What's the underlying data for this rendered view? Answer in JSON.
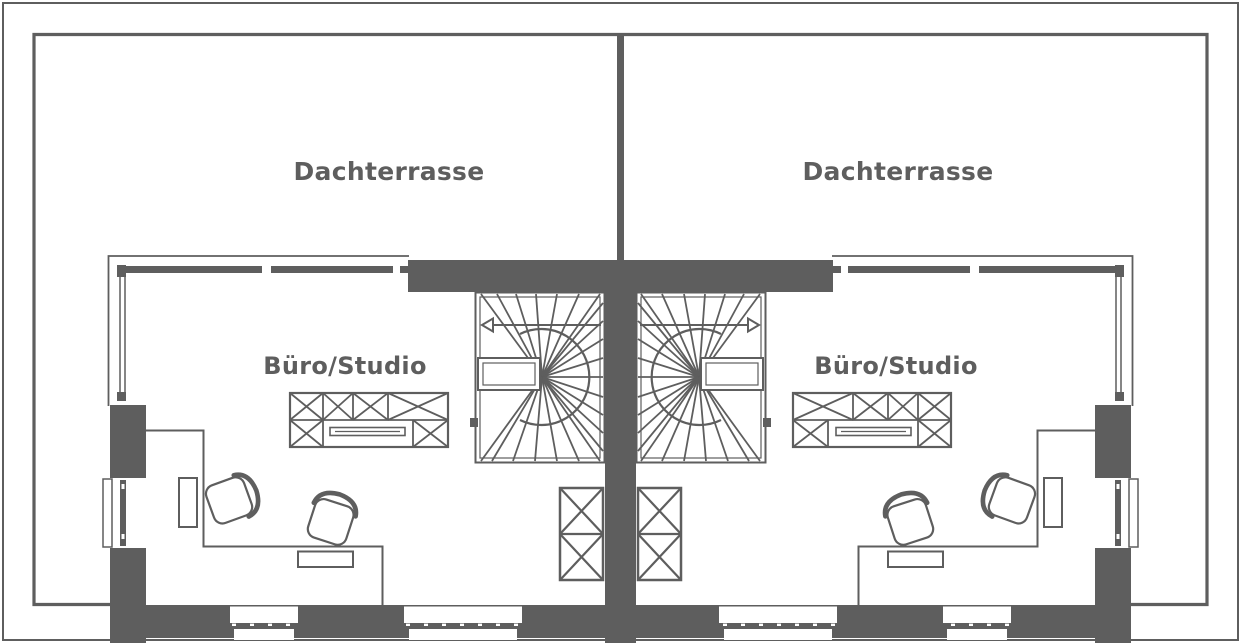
{
  "plan": {
    "type_label": "floor-plan",
    "background": "#ffffff",
    "line_color": "#5e5e5e",
    "units": [
      {
        "side": "left",
        "terrace_label": "Dachterrasse",
        "room_label": "Büro/Studio"
      },
      {
        "side": "right",
        "terrace_label": "Dachterrasse",
        "room_label": "Büro/Studio"
      }
    ]
  }
}
